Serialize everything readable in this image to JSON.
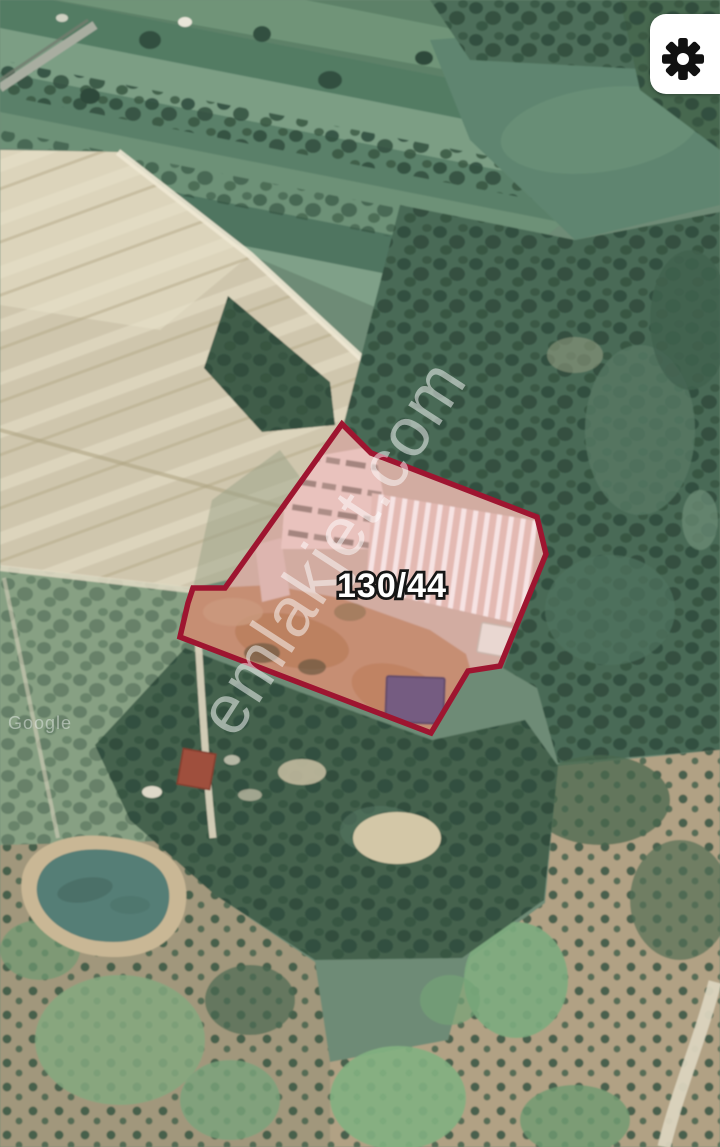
{
  "map": {
    "parcel_label": "130/44",
    "watermark_text": "emlakjet.com",
    "attribution_text": "Google",
    "parcel_outline_color": "#9e1530",
    "parcel_fill_tint": "rgba(205,60,70,0.10)",
    "label_text_color": "#ffffff",
    "label_outline_color": "#161616",
    "watermark_color": "#ffffff"
  },
  "controls": {
    "settings_icon": "gear-icon",
    "settings_button_bg": "#ffffff",
    "settings_icon_color": "#111111"
  }
}
